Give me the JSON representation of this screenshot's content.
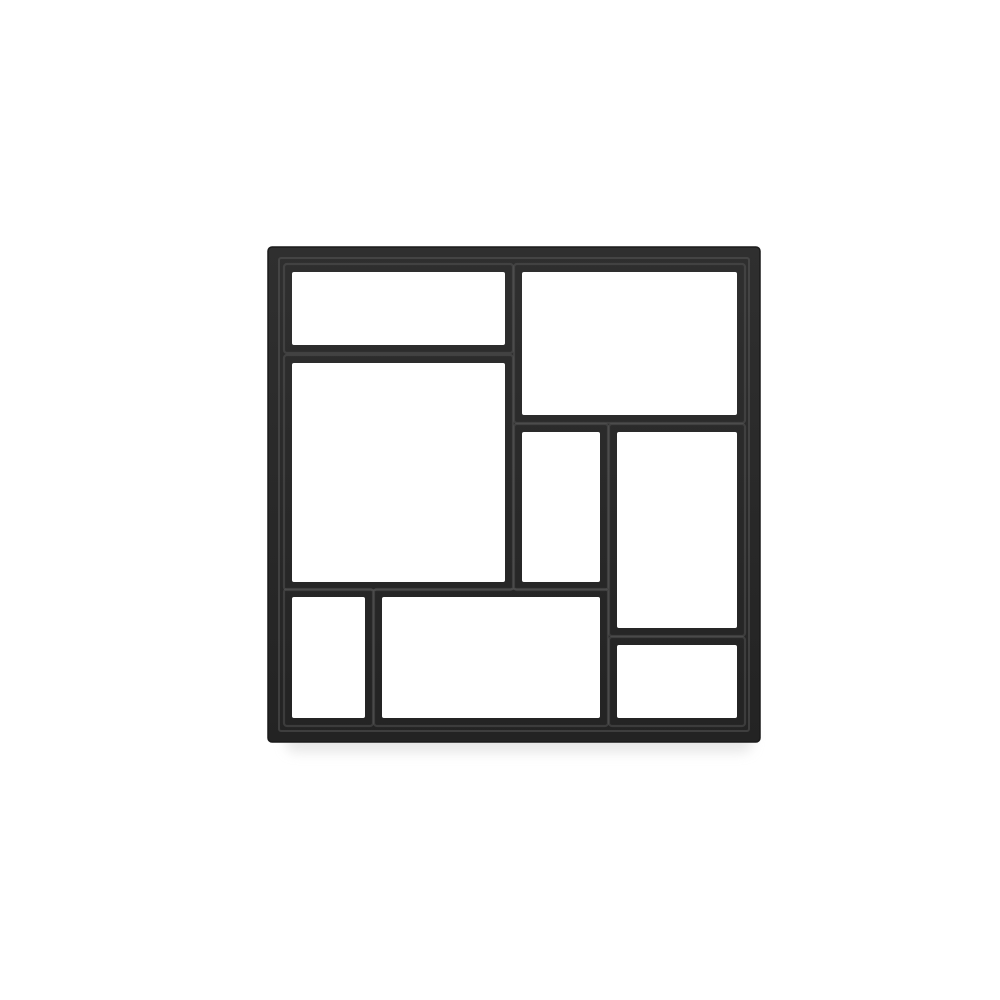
{
  "meta": {
    "kind": "product-photo",
    "subject": "black plastic DIY path maker paving mold with 8 rectangular cavities",
    "canvas": {
      "width": 1000,
      "height": 1000
    }
  },
  "scene": {
    "background_color": "#ffffff",
    "object": {
      "name": "paving-mold",
      "material": "black plastic",
      "cavity_count": 8,
      "colors": {
        "wall_dark": "#232323",
        "wall_mid": "#2f2f2f",
        "rim_highlight": "#5a5a5a",
        "outline": "#1a1a1a",
        "shadow": "#dcdcdc"
      },
      "outer": {
        "x": 268,
        "y": 247,
        "width": 492,
        "height": 495,
        "corner_radius": 4
      },
      "cavities": [
        {
          "name": "top-left",
          "x": 292,
          "y": 272,
          "width": 213,
          "height": 73
        },
        {
          "name": "top-right",
          "x": 522,
          "y": 272,
          "width": 215,
          "height": 143
        },
        {
          "name": "left-large",
          "x": 292,
          "y": 363,
          "width": 213,
          "height": 219
        },
        {
          "name": "center-middle",
          "x": 522,
          "y": 432,
          "width": 78,
          "height": 150
        },
        {
          "name": "right-tall",
          "x": 617,
          "y": 432,
          "width": 120,
          "height": 196
        },
        {
          "name": "bottom-left",
          "x": 292,
          "y": 597,
          "width": 73,
          "height": 121
        },
        {
          "name": "bottom-middle",
          "x": 382,
          "y": 597,
          "width": 218,
          "height": 121
        },
        {
          "name": "bottom-right",
          "x": 617,
          "y": 645,
          "width": 120,
          "height": 73
        }
      ],
      "shadow_rect": {
        "x": 286,
        "y": 726,
        "width": 466,
        "height": 26
      }
    }
  }
}
